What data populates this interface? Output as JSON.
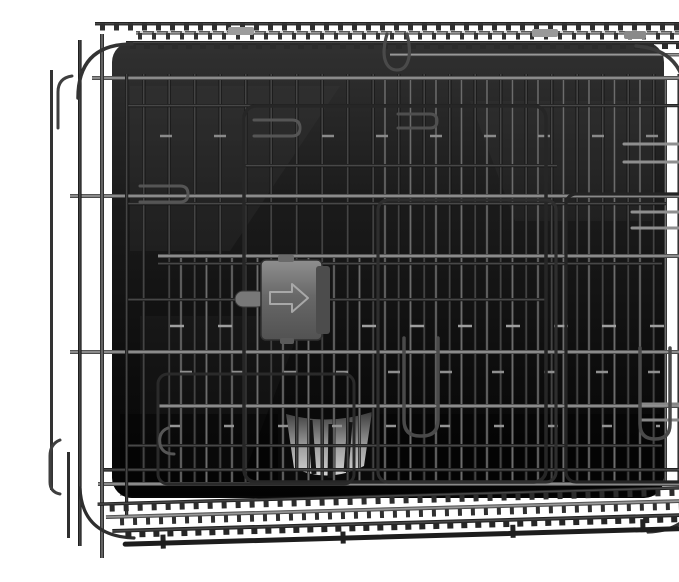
{
  "image": {
    "type": "product-photo",
    "subject": "Folded black metal wire dog crate with plastic pan tray",
    "alt": "A folding wire dog crate collapsed flat, shown front-on against a white background. Black powder-coated wire mesh panels overlap in front of a dark plastic pan; a gray plastic slide-bolt latch with a right-pointing arrow sits left of center, the pan's gray ribbed handle shows through the wires lower-center, and folded mesh panels are seen edge-on along the top and bottom.",
    "background_color": "#ffffff",
    "parts": {
      "crate": "black wire mesh panels, folded flat",
      "pan_tray": "dark plastic floor pan behind the wires",
      "slide_latch": "gray plastic slide latch with embossed right arrow",
      "latch_arrow": "right-pointing arrow",
      "pan_handle": "ribbed gray plastic pan handle",
      "top_hook": "wire loop hanging from the top rail",
      "door_handles": "two elongated wire door pulls",
      "latch_hooks": "U-shaped wire latch hooks on sides",
      "rail_clips": "small gray plastic clips on the top rails",
      "edge_mesh_top": "folded mesh panel seen edge-on along the top",
      "edge_mesh_bottom": "folded mesh panel seen edge-on along the bottom"
    },
    "colors": {
      "background": "#ffffff",
      "wire_dark": "#141414",
      "wire_mid": "#4e4e4e",
      "wire_highlight": "#a8a8a8",
      "tray_dark": "#0c0c0c",
      "tray_mid": "#2b2b2b",
      "latch_gray": "#6f6f6f",
      "latch_arrow_gray": "#a8a8a8",
      "handle_gray": "#c9c9c9",
      "clip_gray": "#9c9c9c"
    }
  }
}
